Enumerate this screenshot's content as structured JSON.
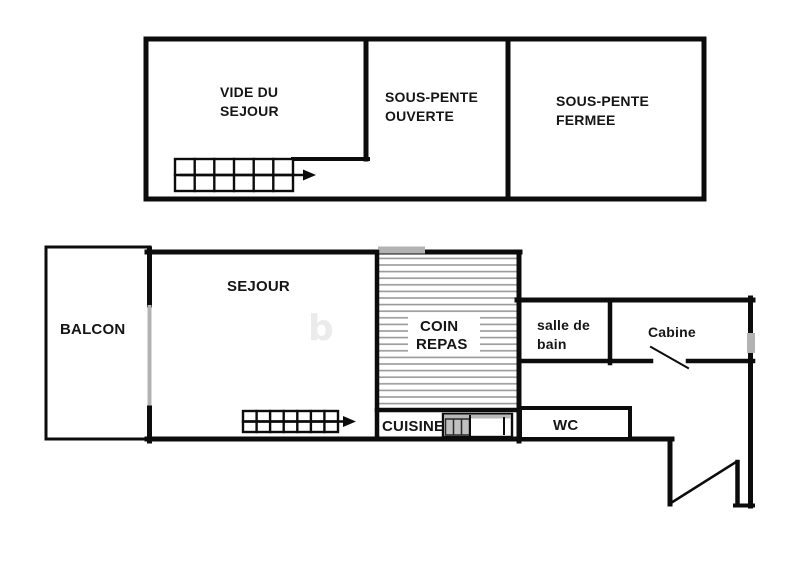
{
  "document": {
    "type": "floor-plan",
    "language": "fr"
  },
  "upper_floor": {
    "vide_du_sejour": {
      "line1": "VIDE DU",
      "line2": "SEJOUR"
    },
    "sous_pente_ouverte": {
      "line1": "SOUS-PENTE",
      "line2": "OUVERTE"
    },
    "sous_pente_fermee": {
      "line1": "SOUS-PENTE",
      "line2": "FERMEE"
    }
  },
  "lower_floor": {
    "balcon": {
      "label": "BALCON"
    },
    "sejour": {
      "label": "SEJOUR"
    },
    "coin_repas": {
      "line1": "COIN",
      "line2": "REPAS"
    },
    "salle_de_bain": {
      "line1": "salle de",
      "line2": "bain"
    },
    "cabine": {
      "label": "Cabine"
    },
    "wc": {
      "label": "WC"
    },
    "cuisine": {
      "label": "CUISINE"
    }
  },
  "watermark": {
    "glyph": "b"
  },
  "symbols": {
    "staircase_upper": "staircase-with-direction-arrow",
    "staircase_lower": "staircase-with-direction-arrow",
    "entrance_door": "open-door-swing",
    "cabine_door": "open-door-swing",
    "windows": "gray-window-markers",
    "coin_repas_area": "horizontal-hatching"
  },
  "colors": {
    "wall": "#0c0c0c",
    "hatch": "#999999",
    "window_marker": "#b3b3b3",
    "kitchen_unit_gray": "#b8b8b8",
    "background": "#ffffff",
    "text": "#151515"
  }
}
